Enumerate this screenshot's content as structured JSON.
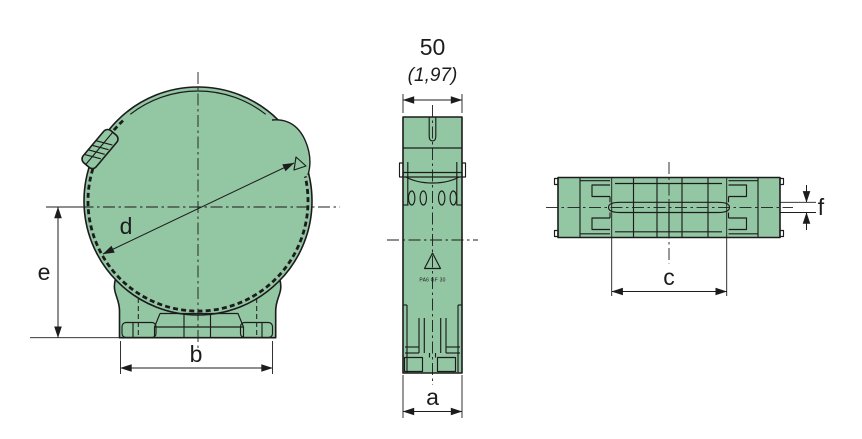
{
  "colors": {
    "part_fill": "#93c6a2",
    "line": "#1c1c1c",
    "background": "#ffffff"
  },
  "dimension_labels": {
    "top_width_mm": "50",
    "top_width_inch": "(1,97)",
    "d": "d",
    "e": "e",
    "b": "b",
    "a": "a",
    "c": "c",
    "f": "f"
  },
  "material_marking": "PA6 GF 30"
}
